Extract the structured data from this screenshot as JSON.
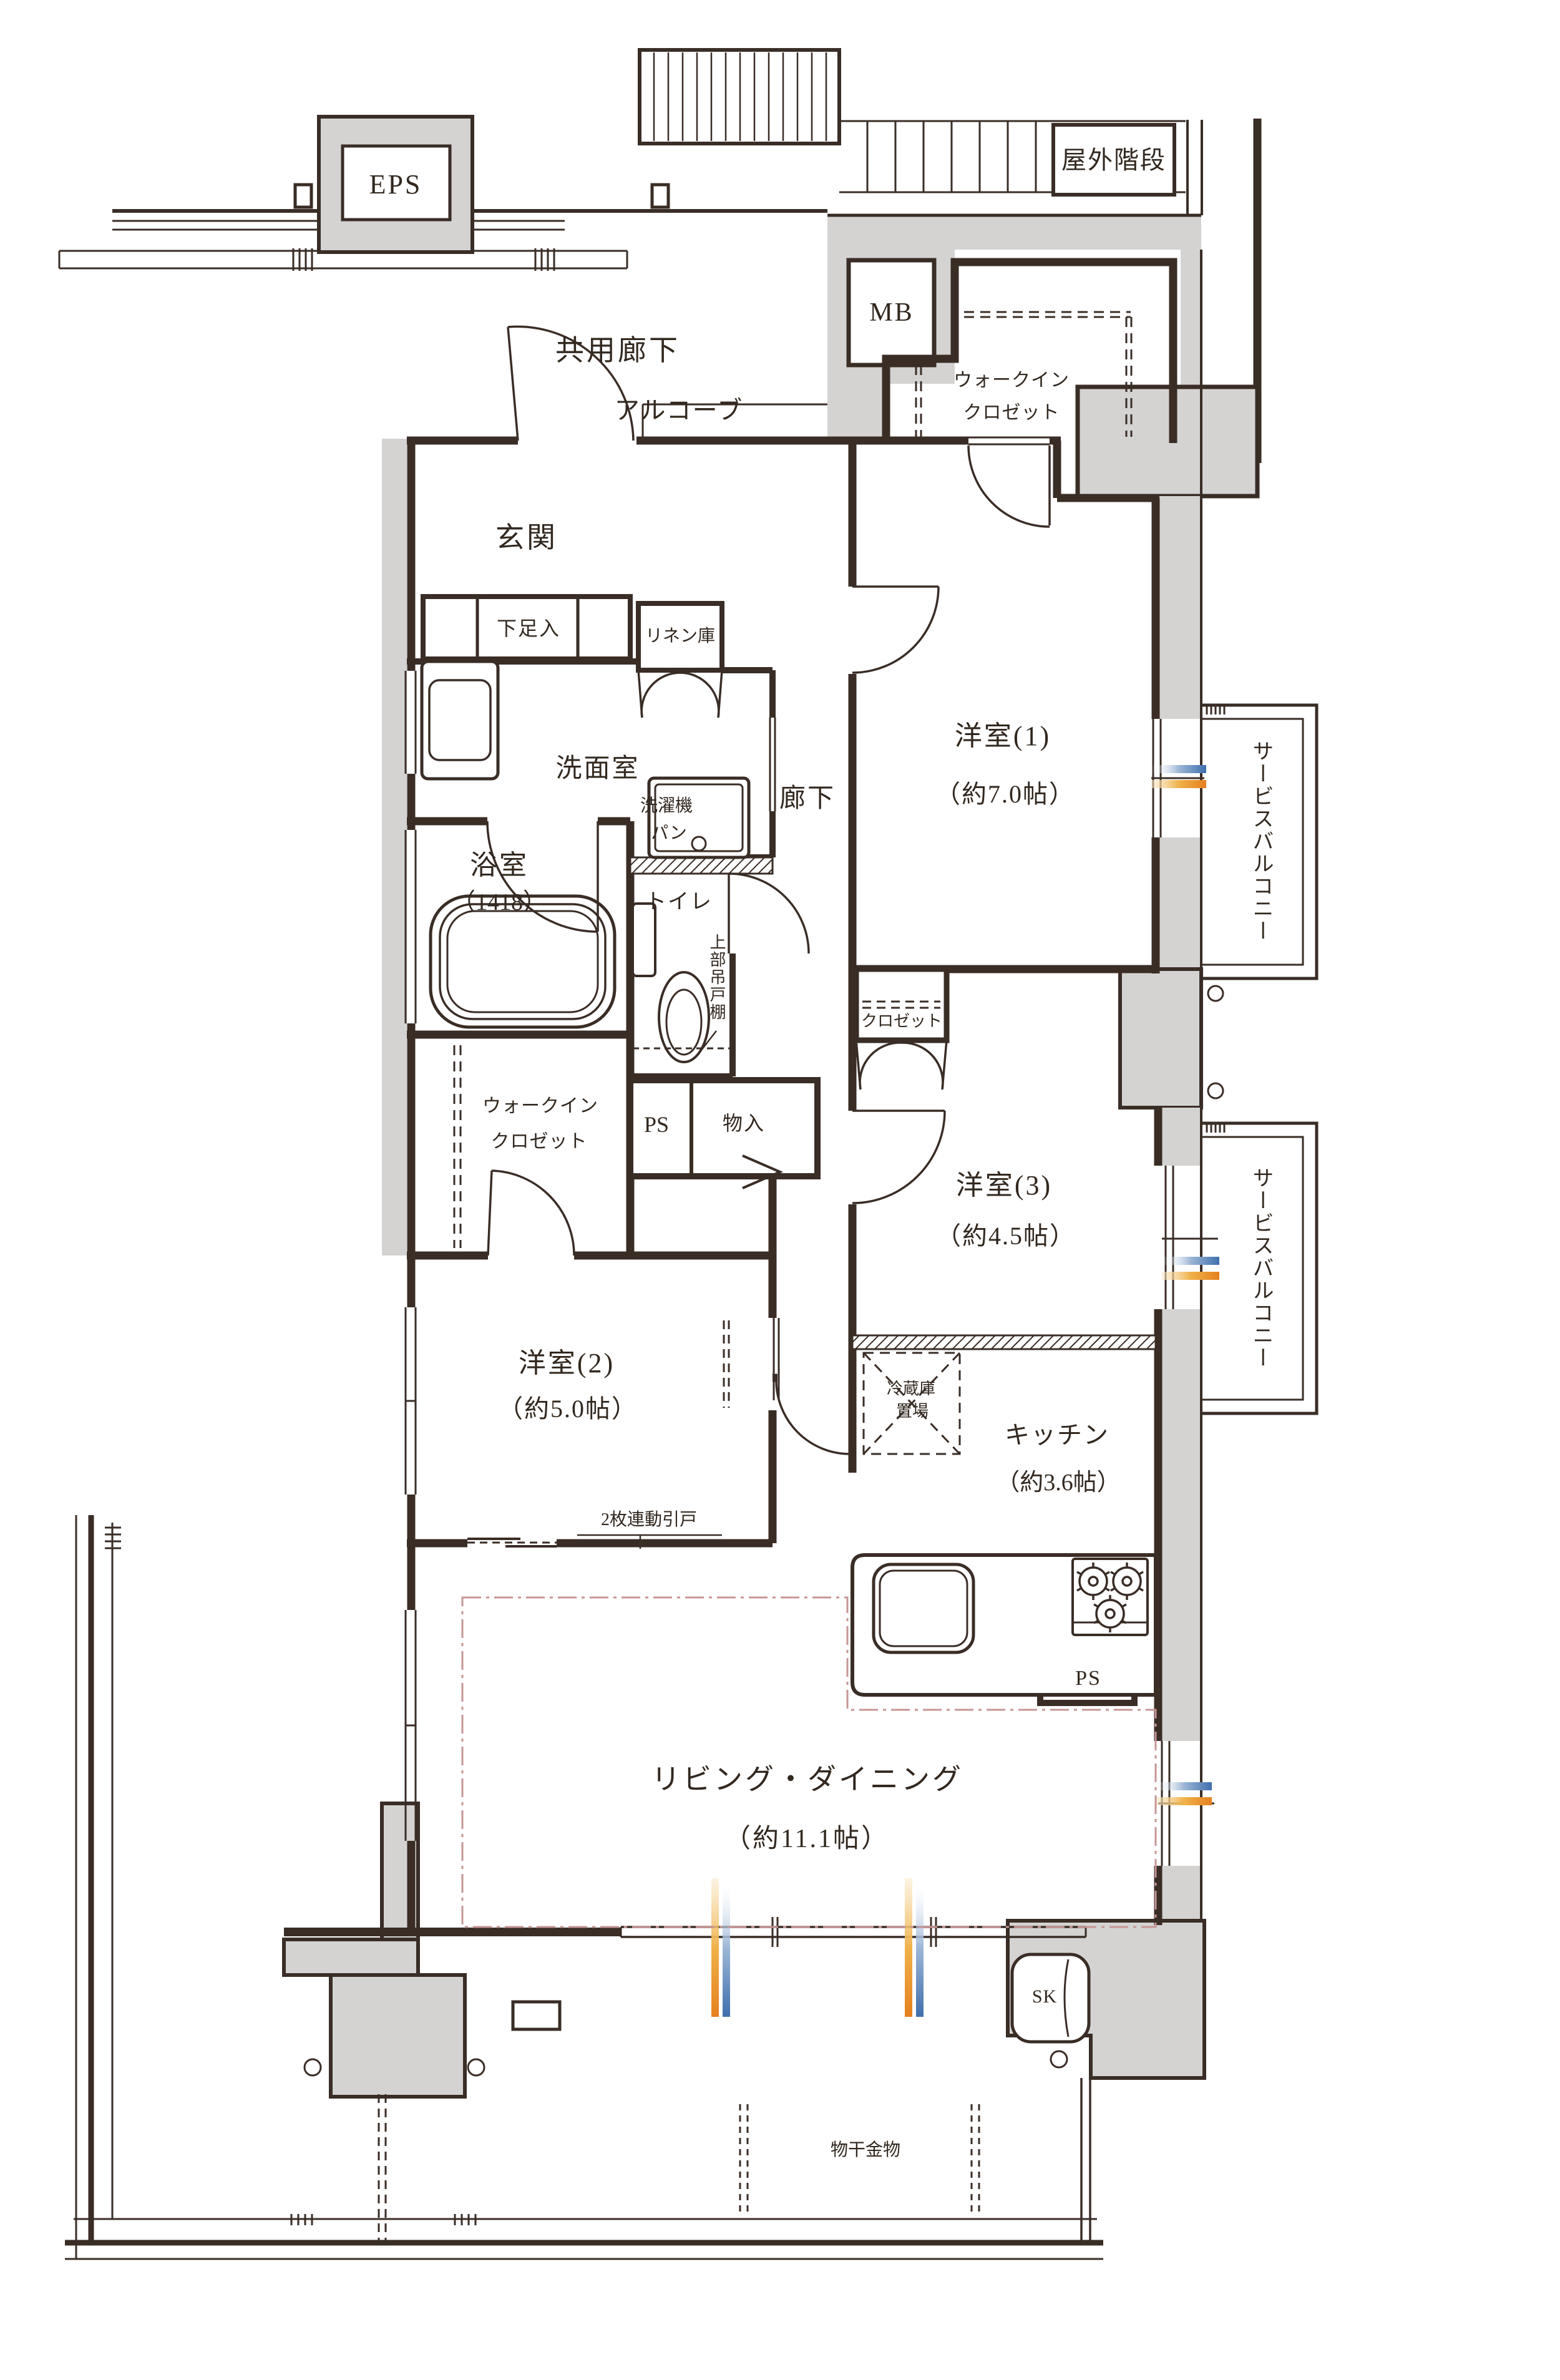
{
  "plan_type": "apartment-floor-plan",
  "colors": {
    "wall": "#3a2d26",
    "concrete_gray": "#d4d3d2",
    "accent_blue": "#3f6fae",
    "accent_orange": "#e5801f",
    "ld_outline_pink": "#c79595"
  },
  "labels": {
    "eps": "EPS",
    "outdoor_stairs": "屋外階段",
    "mb": "MB",
    "corridor": "共用廊下",
    "alcove": "アルコーブ",
    "wic_top_1": "ウォークイン",
    "wic_top_2": "クロゼット",
    "genkan": "玄関",
    "shoe_box": "下足入",
    "linen": "リネン庫",
    "washroom": "洗面室",
    "hallway": "廊下",
    "washer_1": "洗濯機",
    "washer_2": "パン",
    "bath_1": "浴室",
    "bath_2": "（1418）",
    "toilet": "トイレ",
    "upper_cabinet": "上部吊戸棚",
    "ps_1": "PS",
    "storage": "物入",
    "wic_left_1": "ウォークイン",
    "wic_left_2": "クロゼット",
    "closet": "クロゼット",
    "bed1_1": "洋室(1)",
    "bed1_2": "（約7.0帖）",
    "bed3_1": "洋室(3)",
    "bed3_2": "（約4.5帖）",
    "bed2_1": "洋室(2)",
    "bed2_2": "（約5.0帖）",
    "fridge_1": "冷蔵庫",
    "fridge_2": "置場",
    "kitchen_1": "キッチン",
    "kitchen_2": "（約3.6帖）",
    "ps_2": "PS",
    "sliding_door": "2枚連動引戸",
    "living_1": "リビング・ダイニング",
    "living_2": "（約11.1帖）",
    "service_balcony_1": "サービスバルコニー",
    "service_balcony_2": "サービスバルコニー",
    "sk": "SK",
    "laundry_hardware": "物干金物"
  }
}
